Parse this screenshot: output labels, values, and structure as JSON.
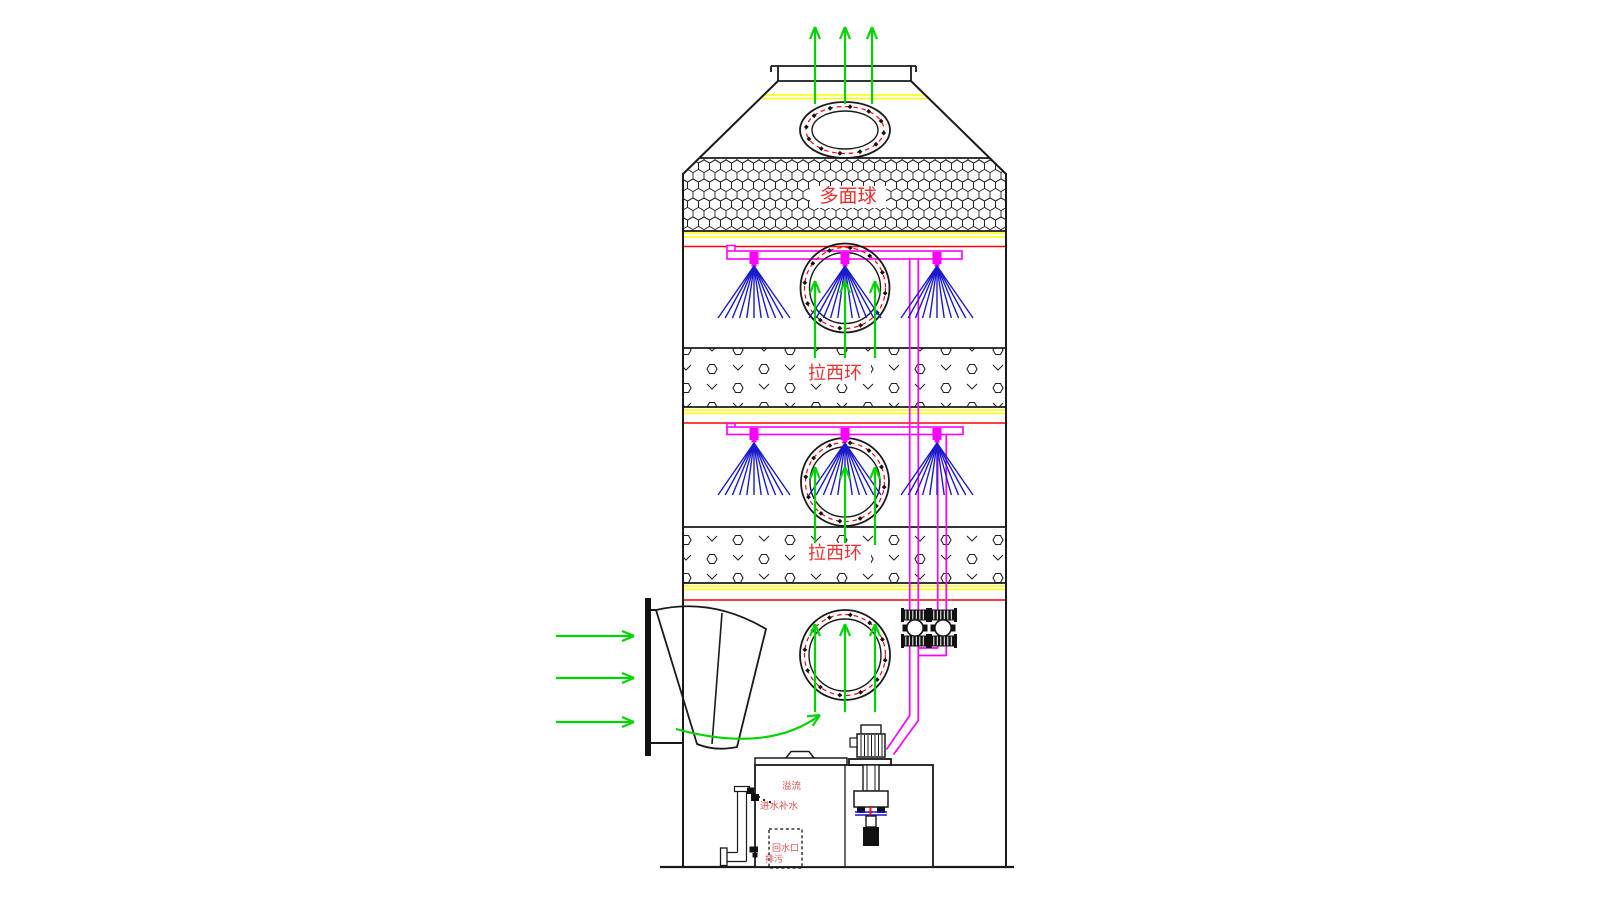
{
  "colors": {
    "line": "#1a1a1a",
    "gas_flow": "#00d400",
    "liquid_pipe": "#ff00ff",
    "spray": "#1a1acd",
    "support_grid": "#ffff00",
    "support_beam": "#ff0000",
    "packing_label": "#e83030",
    "small_label": "#e05050"
  },
  "tower": {
    "packing_sections": [
      {
        "label": "多面球"
      },
      {
        "label": "拉西环"
      },
      {
        "label": "拉西环"
      }
    ],
    "spray_levels": 2,
    "nozzles_per_level": 3,
    "manholes": 4,
    "outlet_arrows": 3,
    "inlet_arrows": 3
  },
  "tank_labels": {
    "overflow": "溢流",
    "makeup_water": "进水补水",
    "return_port": "回水口",
    "drain": "排污"
  }
}
